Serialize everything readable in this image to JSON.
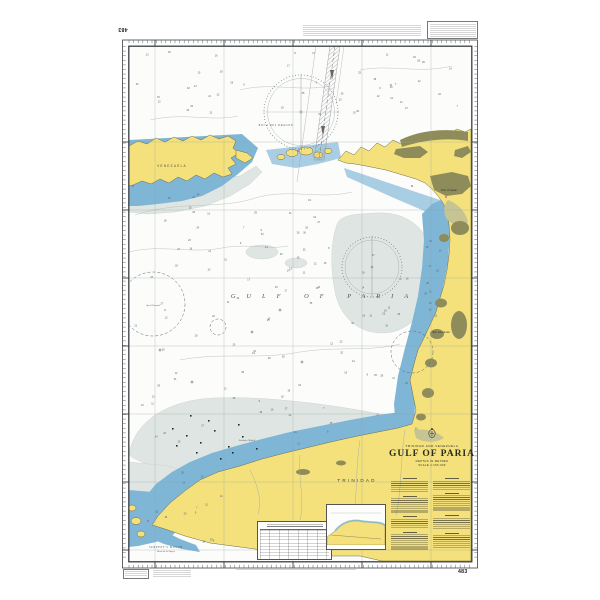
{
  "colors": {
    "land": "#f4e17c",
    "shallow_water": "#7fb6d5",
    "light_shallow": "#a9cde2",
    "bank_tint": "#dfe5e3",
    "urban": "#8e8c5a",
    "mangrove": "#c6c493",
    "deep_water": "#fcfcfa",
    "border_ink": "#3a3f42",
    "light_magenta": "#b05a9a"
  },
  "chart": {
    "number": "483"
  },
  "title_block": {
    "nations": "TRINIDAD AND VENEZUELA",
    "title": "GULF OF PARIA",
    "depths": "DEPTHS IN METRES",
    "scale": "SCALE 1:150,000",
    "crest_icon": "royal-crest"
  },
  "map_labels": [
    {
      "text": "VENEZUELA",
      "x": 172,
      "y": 167,
      "cls": "country"
    },
    {
      "text": "BOCA DEL DRAGON",
      "x": 276,
      "y": 126,
      "cls": "water"
    },
    {
      "text": "GULF OF PARIA",
      "x": 325,
      "y": 298,
      "cls": "sea"
    },
    {
      "text": "TRINIDAD",
      "x": 357,
      "y": 482,
      "cls": "countryBig"
    },
    {
      "text": "SERPENT'S MOUTH",
      "x": 166,
      "y": 548,
      "cls": "water"
    },
    {
      "text": "Boca de la Sierpe",
      "x": 166,
      "y": 552,
      "cls": "tinyItal"
    },
    {
      "text": "Port of Spain",
      "x": 449,
      "y": 191,
      "cls": "town"
    },
    {
      "text": "San Fernando",
      "x": 441,
      "y": 333,
      "cls": "town"
    },
    {
      "text": "Soldado Oilfield",
      "x": 247,
      "y": 441,
      "cls": "tinyItal"
    },
    {
      "text": "Spoil Ground",
      "x": 153,
      "y": 306,
      "cls": "tinyItal"
    }
  ],
  "soundings": [
    9,
    12,
    18,
    22,
    7,
    31,
    25,
    14,
    36,
    20,
    11,
    27,
    16,
    33,
    8,
    24,
    19,
    29,
    13,
    35,
    21,
    10,
    26,
    17,
    30,
    15,
    23,
    34,
    12,
    28,
    18,
    9,
    32,
    22,
    14,
    25,
    11,
    19,
    27,
    16
  ]
}
